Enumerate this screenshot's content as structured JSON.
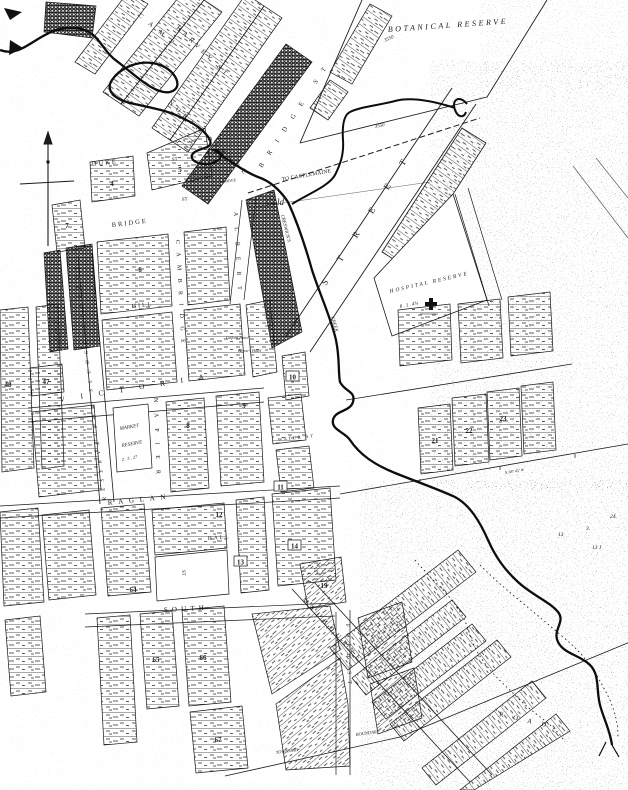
{
  "map": {
    "reserves": {
      "botanical": "BOTANICAL RESERVE",
      "hospital": "HOSPITAL RESERVE",
      "hospital_area": "8 . 1 . 4¾",
      "market1": "MARKET",
      "market2": "RESERVE",
      "market_area": "2 . 3 . 27",
      "sludge": "RESERVE FOR SLUDGE CHANNEL"
    },
    "streets": {
      "camp": "CAMP",
      "harvey": "HARVEY ST",
      "north_parade": "NORTH PARADE",
      "bridge_diag": "BRIDGE ST",
      "duke": "DUKE",
      "duke_st": "ST",
      "bridge_town": "BRIDGE",
      "bridge_town_st": "ST",
      "cambridge": "CAMBRIDGE",
      "albert": "ALBERT",
      "hill": "HILL",
      "main": "STREET",
      "victoria": "VICTORIA",
      "napier": "NAPIER",
      "raglan": "RAGLAN",
      "hall": "HALL",
      "hall_st": "ST",
      "water": "WATER ST",
      "south": "SOUTH",
      "melbourne": "MELBOURNE",
      "ford": "FORD ST",
      "road": "ROAD",
      "to_castlemaine": "TO CASTLEMAINE"
    },
    "creek": {
      "creswicks": "CRESWICK'S",
      "creek": "CREEK",
      "bridge": "BRIDGE"
    },
    "places": {
      "gold": "Gold",
      "gilford_hotel": "Gilford Hotel",
      "baynes_hotel": "Bayne's Hotel"
    },
    "boundary": {
      "township": "TOWNSHIP",
      "boundary": "BOUNDARY"
    },
    "measurements": {
      "dist_a": "3550",
      "dist_b": "3550",
      "bearing": "N 38° 45' W",
      "n24": "24.",
      "n3": "3.",
      "n13": "13",
      "n13j": "13 J"
    },
    "blocks": {
      "b4": "4",
      "b5": "5",
      "b6": "6",
      "b7": "7",
      "b8": "8",
      "b9": "9",
      "b10": "10",
      "b11": "11",
      "b12": "12",
      "b13": "13",
      "b14": "14",
      "b19": "19",
      "b21": "21",
      "b22": "22",
      "b23": "23",
      "b47": "47",
      "b48": "48",
      "b64": "64",
      "b65": "65",
      "b66": "66",
      "b67": "67"
    }
  }
}
